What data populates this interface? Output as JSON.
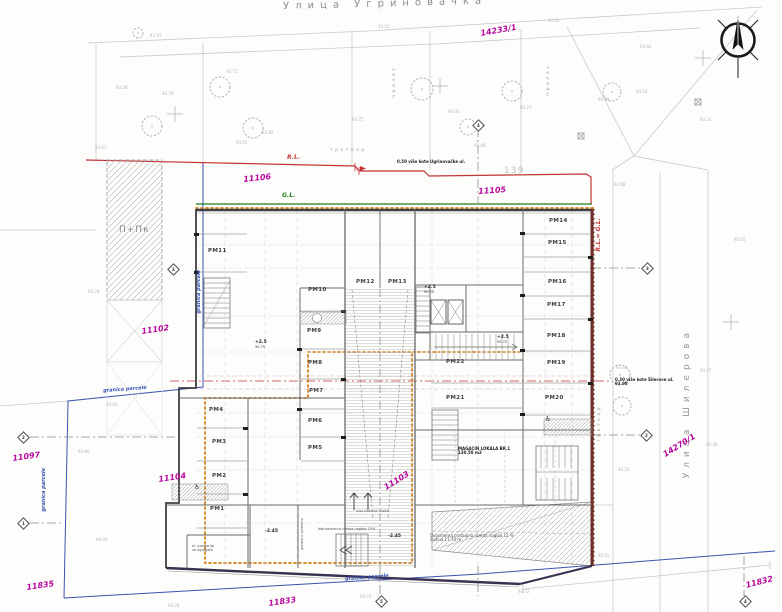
{
  "streets": {
    "top": "Улица Угриновачка",
    "right": "Улица Шилерова"
  },
  "labels": {
    "sidewalk_top": "тротоар",
    "sidewalk_right": "тротоар",
    "approach_left": "прилаз",
    "approach_right": "прилаз",
    "existing_building": "П+Пк",
    "regulation_line": "R.L.",
    "building_line": "G.L.",
    "regulation_equals_building": "R.L.= G.L.",
    "plot_number_big": "139",
    "magacin": "MAGACIN LOKALA BR.1",
    "magacin_area": "130.50 m2",
    "ramp_two_way_1": "Dvosmerna pristupna rampa nagiba 12 %",
    "ramp_two_way_2": "dužina 17.70 m",
    "ramp_one_way": "Jednosmerna rampa nagiba 15%",
    "garage_entry": "ulaz-izlaz za vozila",
    "garage_vertical": "garaža u suterenu",
    "note_top": "0.50 više kote Ugrinovačke ul.",
    "note_right_1": "0.30 više kote Šilerove ul.",
    "note_right_2": "93.98",
    "el_room_1": "el. prostorija",
    "el_room_2": "za agregate",
    "wheelchair_symbol": "♿"
  },
  "boundary": {
    "label": "granica parcele",
    "positions": [
      {
        "x": 103,
        "y": 389,
        "rot": -4,
        "vertical": false
      },
      {
        "x": 42,
        "y": 468,
        "rot": 0,
        "vertical": true
      },
      {
        "x": 197,
        "y": 270,
        "rot": 0,
        "vertical": true
      },
      {
        "x": 345,
        "y": 577,
        "rot": -4,
        "vertical": false
      }
    ]
  },
  "parcel_numbers": [
    {
      "text": "14233/1",
      "x": 480,
      "y": 30,
      "rot": -10
    },
    {
      "text": "11106",
      "x": 243,
      "y": 176,
      "rot": -6
    },
    {
      "text": "11105",
      "x": 478,
      "y": 188,
      "rot": -4
    },
    {
      "text": "11102",
      "x": 141,
      "y": 328,
      "rot": -8
    },
    {
      "text": "11097",
      "x": 12,
      "y": 455,
      "rot": -8
    },
    {
      "text": "11104",
      "x": 158,
      "y": 476,
      "rot": -8
    },
    {
      "text": "11103",
      "x": 383,
      "y": 485,
      "rot": -32
    },
    {
      "text": "11835",
      "x": 26,
      "y": 584,
      "rot": -8
    },
    {
      "text": "11833",
      "x": 268,
      "y": 600,
      "rot": -8
    },
    {
      "text": "11832",
      "x": 745,
      "y": 582,
      "rot": -14
    },
    {
      "text": "14270/1",
      "x": 662,
      "y": 452,
      "rot": -32
    }
  ],
  "parking_spots": [
    {
      "id": "PM1",
      "x": 210,
      "y": 507
    },
    {
      "id": "PM2",
      "x": 212,
      "y": 474
    },
    {
      "id": "PM3",
      "x": 212,
      "y": 440
    },
    {
      "id": "PM4",
      "x": 209,
      "y": 408
    },
    {
      "id": "PM5",
      "x": 308,
      "y": 446
    },
    {
      "id": "PM6",
      "x": 308,
      "y": 419
    },
    {
      "id": "PM7",
      "x": 309,
      "y": 389
    },
    {
      "id": "PM8",
      "x": 308,
      "y": 361
    },
    {
      "id": "PM9",
      "x": 307,
      "y": 329
    },
    {
      "id": "PM10",
      "x": 308,
      "y": 288
    },
    {
      "id": "PM11",
      "x": 208,
      "y": 249
    },
    {
      "id": "PM12",
      "x": 356,
      "y": 280
    },
    {
      "id": "PM13",
      "x": 388,
      "y": 280
    },
    {
      "id": "PM14",
      "x": 549,
      "y": 219
    },
    {
      "id": "PM15",
      "x": 548,
      "y": 241
    },
    {
      "id": "PM16",
      "x": 548,
      "y": 280
    },
    {
      "id": "PM17",
      "x": 547,
      "y": 303
    },
    {
      "id": "PM18",
      "x": 547,
      "y": 334
    },
    {
      "id": "PM19",
      "x": 547,
      "y": 361
    },
    {
      "id": "PM20",
      "x": 545,
      "y": 396
    },
    {
      "id": "PM21",
      "x": 446,
      "y": 396
    },
    {
      "id": "PM22",
      "x": 446,
      "y": 360
    }
  ],
  "level_marks": [
    {
      "text": "+2.5",
      "sub": "90.75",
      "x": 424,
      "y": 286
    },
    {
      "text": "+2.5",
      "sub": "90.75",
      "x": 497,
      "y": 336
    },
    {
      "text": "+2.5",
      "sub": "90.75",
      "x": 255,
      "y": 341
    },
    {
      "text": "-2.45",
      "sub": "",
      "x": 265,
      "y": 530
    },
    {
      "text": "-2.45",
      "sub": "",
      "x": 388,
      "y": 535
    }
  ],
  "elevation_marks": [
    {
      "v": "43.47",
      "x": 150,
      "y": 34
    },
    {
      "v": "43.52",
      "x": 378,
      "y": 25
    },
    {
      "v": "43.41",
      "x": 548,
      "y": 19
    },
    {
      "v": "93.58",
      "x": 116,
      "y": 86
    },
    {
      "v": "93.70",
      "x": 162,
      "y": 92
    },
    {
      "v": "93.71",
      "x": 226,
      "y": 70
    },
    {
      "v": "93.82",
      "x": 262,
      "y": 131
    },
    {
      "v": "93.75",
      "x": 352,
      "y": 118
    },
    {
      "v": "94.05",
      "x": 448,
      "y": 110
    },
    {
      "v": "93.77",
      "x": 520,
      "y": 106
    },
    {
      "v": "92.59",
      "x": 598,
      "y": 98
    },
    {
      "v": "93.62",
      "x": 640,
      "y": 45
    },
    {
      "v": "93.24",
      "x": 700,
      "y": 118
    },
    {
      "v": "93.41",
      "x": 95,
      "y": 146
    },
    {
      "v": "93.55",
      "x": 236,
      "y": 141
    },
    {
      "v": "93.48",
      "x": 474,
      "y": 144
    },
    {
      "v": "93.18",
      "x": 636,
      "y": 90
    },
    {
      "v": "93.46",
      "x": 616,
      "y": 366
    },
    {
      "v": "93.57",
      "x": 700,
      "y": 369
    },
    {
      "v": "93.08",
      "x": 614,
      "y": 183
    },
    {
      "v": "93.10",
      "x": 618,
      "y": 468
    },
    {
      "v": "93.38",
      "x": 706,
      "y": 443
    },
    {
      "v": "93.05",
      "x": 734,
      "y": 238
    },
    {
      "v": "93.78",
      "x": 88,
      "y": 290
    },
    {
      "v": "93.66",
      "x": 78,
      "y": 450
    },
    {
      "v": "93.84",
      "x": 106,
      "y": 403
    },
    {
      "v": "94.03",
      "x": 96,
      "y": 538
    },
    {
      "v": "94.28",
      "x": 168,
      "y": 604
    },
    {
      "v": "93.75",
      "x": 360,
      "y": 595
    },
    {
      "v": "93.55",
      "x": 598,
      "y": 554
    },
    {
      "v": "93.72",
      "x": 518,
      "y": 590
    }
  ],
  "survey_points": [
    {
      "n": "4",
      "x": 474,
      "y": 121
    },
    {
      "n": "3",
      "x": 643,
      "y": 264
    },
    {
      "n": "2",
      "x": 642,
      "y": 431
    },
    {
      "n": "2",
      "x": 19,
      "y": 433
    },
    {
      "n": "3",
      "x": 169,
      "y": 265
    },
    {
      "n": "1",
      "x": 19,
      "y": 519
    },
    {
      "n": "5",
      "x": 377,
      "y": 597
    },
    {
      "n": "4",
      "x": 741,
      "y": 597
    }
  ],
  "wheelchair_positions": [
    {
      "x": 194,
      "y": 484
    },
    {
      "x": 545,
      "y": 416
    }
  ],
  "trees": [
    {
      "x": 138,
      "y": 33,
      "r": 5
    },
    {
      "x": 152,
      "y": 126,
      "r": 10
    },
    {
      "x": 220,
      "y": 87,
      "r": 10
    },
    {
      "x": 253,
      "y": 128,
      "r": 10
    },
    {
      "x": 422,
      "y": 89,
      "r": 11
    },
    {
      "x": 512,
      "y": 91,
      "r": 10
    },
    {
      "x": 612,
      "y": 92,
      "r": 9
    },
    {
      "x": 468,
      "y": 127,
      "r": 8
    },
    {
      "x": 620,
      "y": 375,
      "r": 10
    },
    {
      "x": 622,
      "y": 406,
      "r": 9
    }
  ],
  "crosses": [
    {
      "x": 175,
      "y": 114
    },
    {
      "x": 440,
      "y": 86
    },
    {
      "x": 731,
      "y": 322
    },
    {
      "x": 703,
      "y": 58
    }
  ],
  "utility_boxes": [
    {
      "x": 578,
      "y": 133
    },
    {
      "x": 695,
      "y": 99
    }
  ],
  "colors": {
    "parcel_magenta": "#b8089e",
    "boundary_blue": "#3853b4",
    "regulation_red": "#c23434",
    "building_green": "#1e7d1e",
    "envelope_orange": "#d4821c",
    "wall_dark": "#3f3f3f"
  }
}
